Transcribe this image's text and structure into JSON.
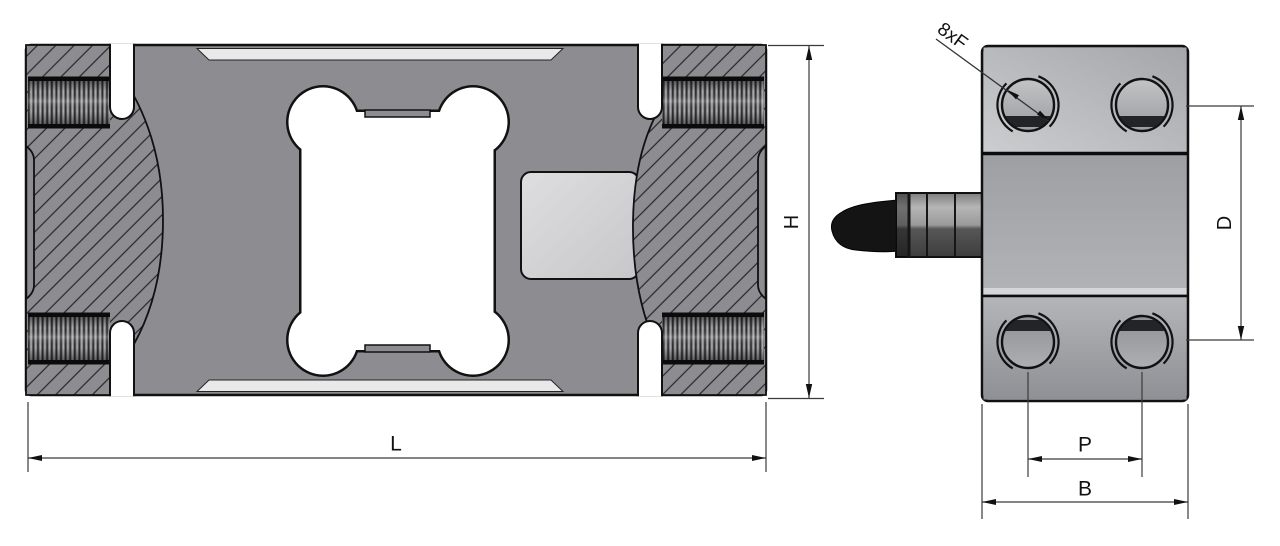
{
  "page": {
    "background": "#ffffff"
  },
  "drawing": {
    "type": "engineering-drawing",
    "subject": "single point load cell, two orthographic views with dimension callouts",
    "views": [
      {
        "id": "top-view",
        "name": "load cell top section view"
      },
      {
        "id": "side-view",
        "name": "load cell side view with cable"
      }
    ],
    "labels": {
      "length": "L",
      "height": "H",
      "hole_callout": "8xF",
      "hole_row_distance": "D",
      "hole_pitch": "P",
      "body_width": "B"
    },
    "colors": {
      "body_gray": "#8d8d91",
      "pocket_gray": "#d5d5d8",
      "highlight_strip": "#e9e9ea",
      "outline": "#111111",
      "dimension_line": "#3a3a3a",
      "cable_black": "#141414",
      "cutout_white": "#ffffff"
    }
  }
}
